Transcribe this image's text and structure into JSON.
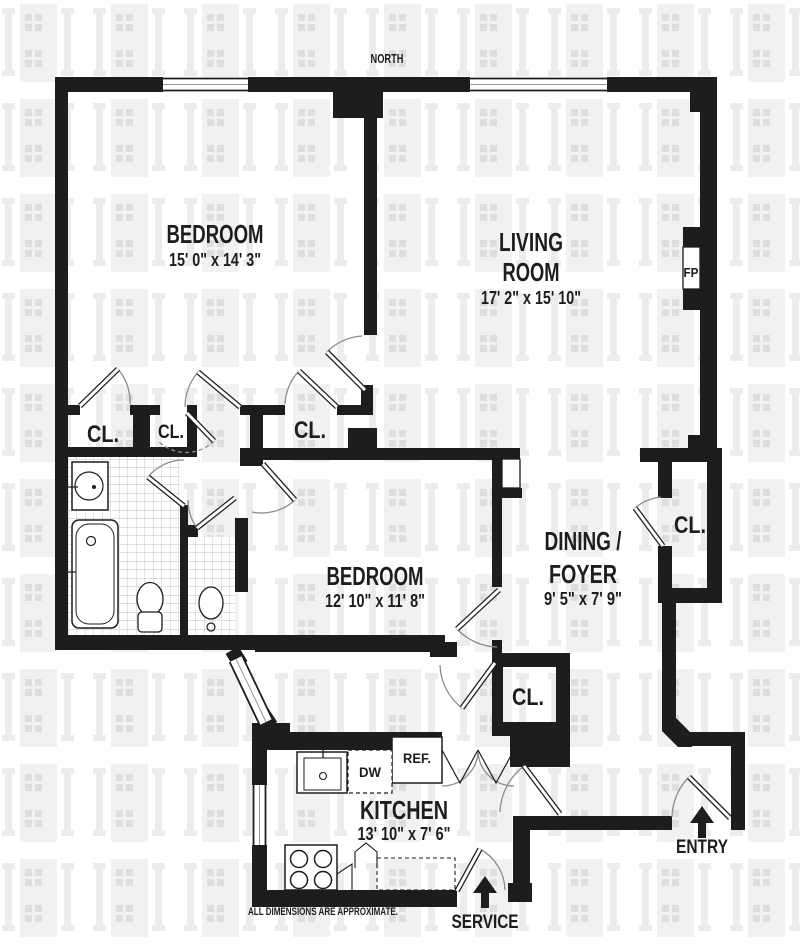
{
  "plan": {
    "north_label": "NORTH",
    "disclaimer": "ALL DIMENSIONS ARE APPROXIMATE.",
    "rooms": {
      "bedroom1": {
        "name": "BEDROOM",
        "dims": "15' 0\" x 14' 3\""
      },
      "living": {
        "line1": "LIVING",
        "line2": "ROOM",
        "dims": "17' 2\" x 15' 10\""
      },
      "bedroom2": {
        "name": "BEDROOM",
        "dims": "12' 10\" x 11' 8\""
      },
      "dining": {
        "line1": "DINING /",
        "line2": "FOYER",
        "dims": "9' 5\" x 7' 9\""
      },
      "kitchen": {
        "name": "KITCHEN",
        "dims": "13' 10\" x 7' 6\""
      }
    },
    "closets": {
      "bedroom1_left": "CL.",
      "bedroom1_small": "CL.",
      "bedroom1_mid": "CL.",
      "dining": "CL.",
      "hall": "CL."
    },
    "fixtures": {
      "fireplace": "FP",
      "dishwasher": "DW",
      "refrigerator": "REF."
    },
    "entrances": {
      "entry": "ENTRY",
      "service": "SERVICE"
    },
    "icons": {
      "entry_arrow": "up-arrow",
      "service_arrow": "up-arrow"
    },
    "colors": {
      "wall": "#1d1d1d",
      "watermark": "#ececec",
      "door_arc": "#8c8c8c",
      "tile_line": "#b0b0b0"
    }
  }
}
